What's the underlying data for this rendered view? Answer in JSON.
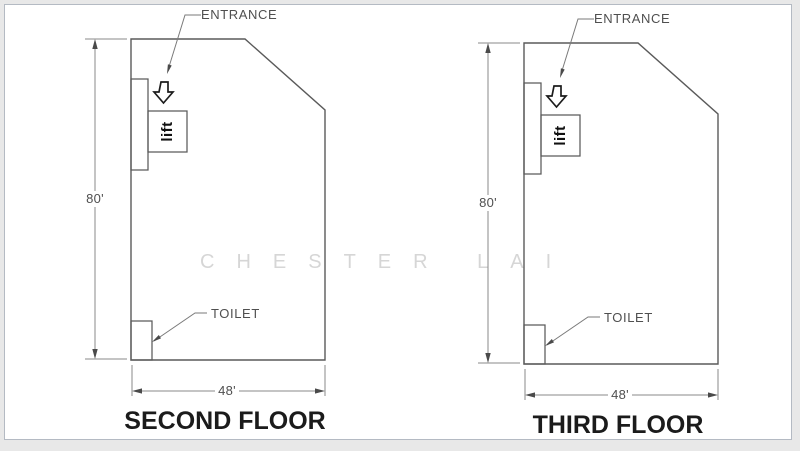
{
  "watermark": {
    "text": "CHESTER LAI",
    "color": "#d6d6d6"
  },
  "colors": {
    "page_background": "#e8e8e8",
    "panel_background": "#ffffff",
    "panel_border": "#b4bac3",
    "outline_stroke": "#5a5a5a",
    "dimension_line": "#8a8a8a",
    "arrowhead_fill": "#4a4a4a",
    "label_text": "#4f4f4f",
    "title_text": "#1b1b1b",
    "entrance_arrow_outline": "#1c1c1c",
    "lift_text": "#111111"
  },
  "plans": [
    {
      "title": "SECOND FLOOR",
      "labels": {
        "entrance": "ENTRANCE",
        "toilet": "TOILET",
        "lift": "lift"
      },
      "dimensions": {
        "height": "80'",
        "width": "48'"
      }
    },
    {
      "title": "THIRD FLOOR",
      "labels": {
        "entrance": "ENTRANCE",
        "toilet": "TOILET",
        "lift": "lift"
      },
      "dimensions": {
        "height": "80'",
        "width": "48'"
      }
    }
  ]
}
